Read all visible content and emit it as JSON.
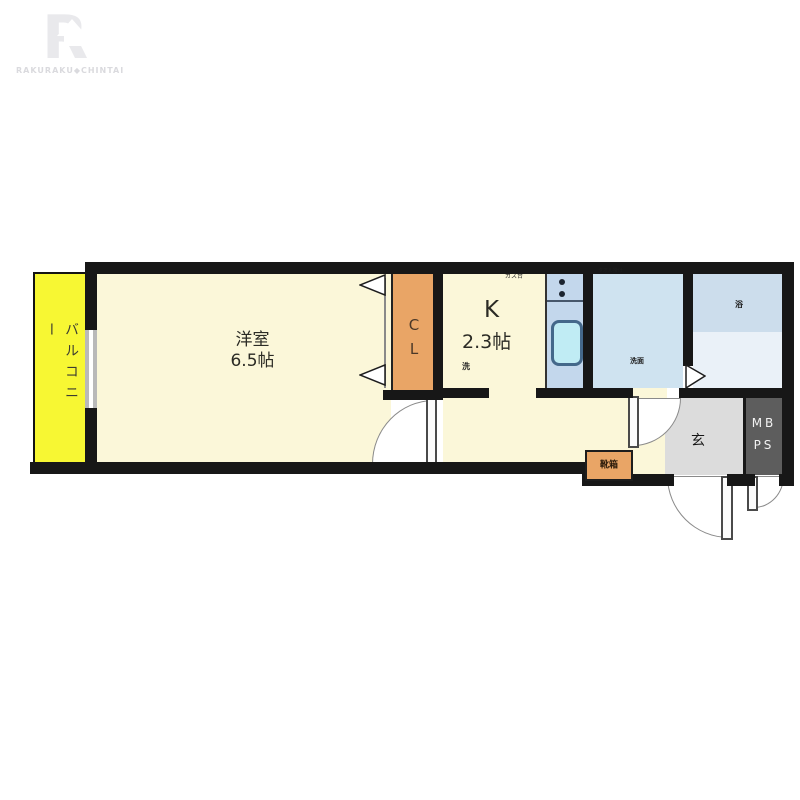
{
  "brand": {
    "logo_letter": "R",
    "logo_text": "RAKURAKU◆CHINTAI"
  },
  "plan": {
    "balcony_label": "バルコニー",
    "room_label": "洋室",
    "room_size": "6.5帖",
    "closet_label": "CL",
    "kitchen_label": "K",
    "kitchen_size": "2.3帖",
    "gas_label": "ガス台",
    "washer_label": "洗",
    "towel_label": "タオル掛け",
    "basin_label": "洗面",
    "tub_label": "浴",
    "entrance_label": "玄",
    "meterbox_line1": "MB",
    "meterbox_line2": "PS",
    "shoebox_label": "靴箱"
  },
  "colors": {
    "balcony": "#f7f733",
    "floor": "#fbf7d9",
    "closet": "#e9a566",
    "water_room": "#cfe3f0",
    "fixture_blue": "#7cd6e8",
    "genkan": "#dcdcdc",
    "meterbox": "#5d5d5d",
    "wall": "#171717"
  }
}
